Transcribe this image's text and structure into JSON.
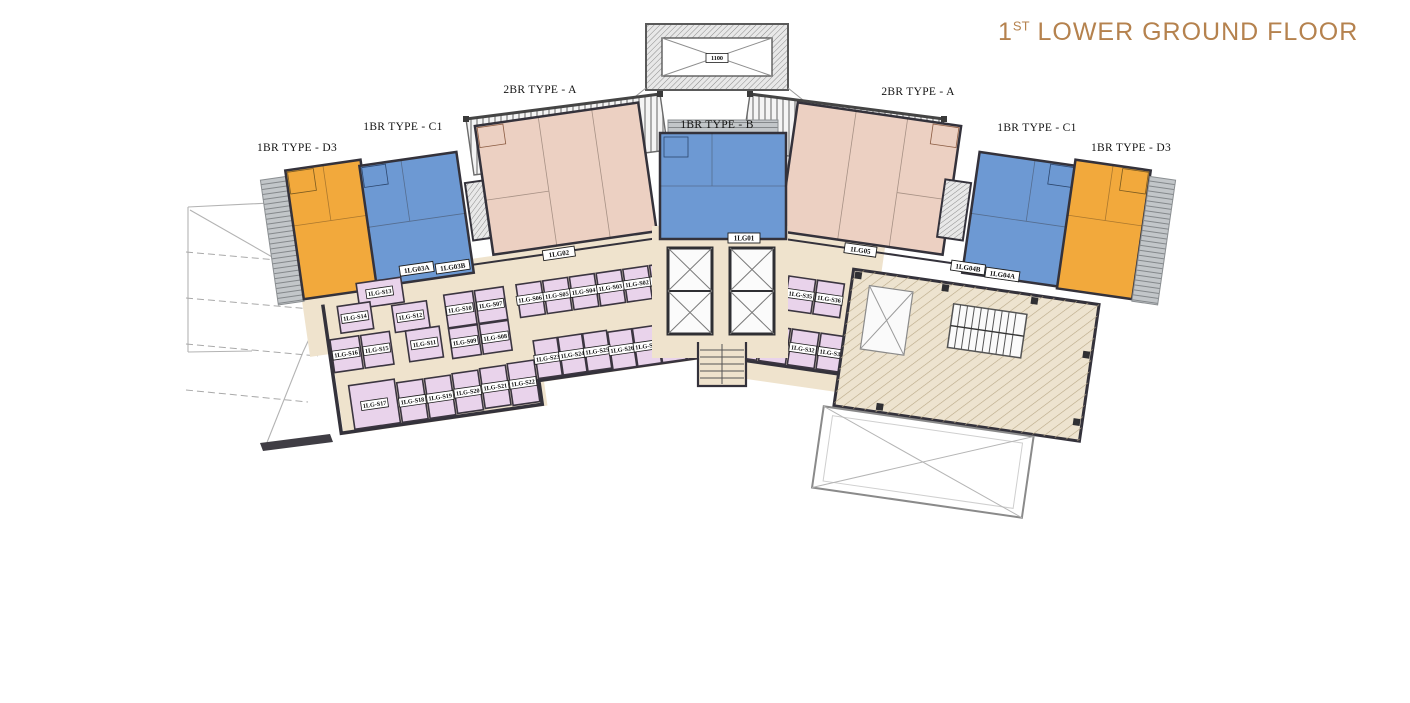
{
  "title": {
    "prefix": "1",
    "sup": "ST",
    "rest": " LOWER GROUND FLOOR"
  },
  "unit_type_labels": {
    "d3_left": "1BR TYPE - D3",
    "c1_left": "1BR TYPE - C1",
    "a_left": "2BR TYPE - A",
    "b_center": "1BR TYPE - B",
    "a_right": "2BR TYPE - A",
    "c1_right": "1BR TYPE - C1",
    "d3_right": "1BR TYPE - D3"
  },
  "unit_tags": {
    "lg01": "1LG01",
    "lg02": "1LG02",
    "lg03a": "1LG03A",
    "lg03b": "1LG03B",
    "lg04a": "1LG04A",
    "lg04b": "1LG04B",
    "lg05": "1LG05"
  },
  "storage_units": [
    "1LG-S01",
    "1LG-S02",
    "1LG-S03",
    "1LG-S04",
    "1LG-S05",
    "1LG-S06",
    "1LG-S07",
    "1LG-S08",
    "1LG-S09",
    "1LG-S10",
    "1LG-S11",
    "1LG-S12",
    "1LG-S13",
    "1LG-S14",
    "1LG-S15",
    "1LG-S16",
    "1LG-S17",
    "1LG-S18",
    "1LG-S19",
    "1LG-S20",
    "1LG-S21",
    "1LG-S22",
    "1LG-S23",
    "1LG-S24",
    "1LG-S25",
    "1LG-S26",
    "1LG-S27",
    "1LG-S28",
    "1LG-S29",
    "1LG-S30",
    "1LG-S31",
    "1LG-S32",
    "1LG-S33",
    "1LG-S34",
    "1LG-S35",
    "1LG-S36"
  ],
  "shaft_label": "1100",
  "colors": {
    "title_accent": "#B5824E",
    "unit_1br_d3": "#F2A93C",
    "unit_1br_c1": "#6D99D3",
    "unit_2br_a": "#ECD0C2",
    "unit_1br_b": "#6D99D3",
    "storage": "#E9D3EB",
    "corridor": "#EFE3CD",
    "walls": "#34323B"
  }
}
